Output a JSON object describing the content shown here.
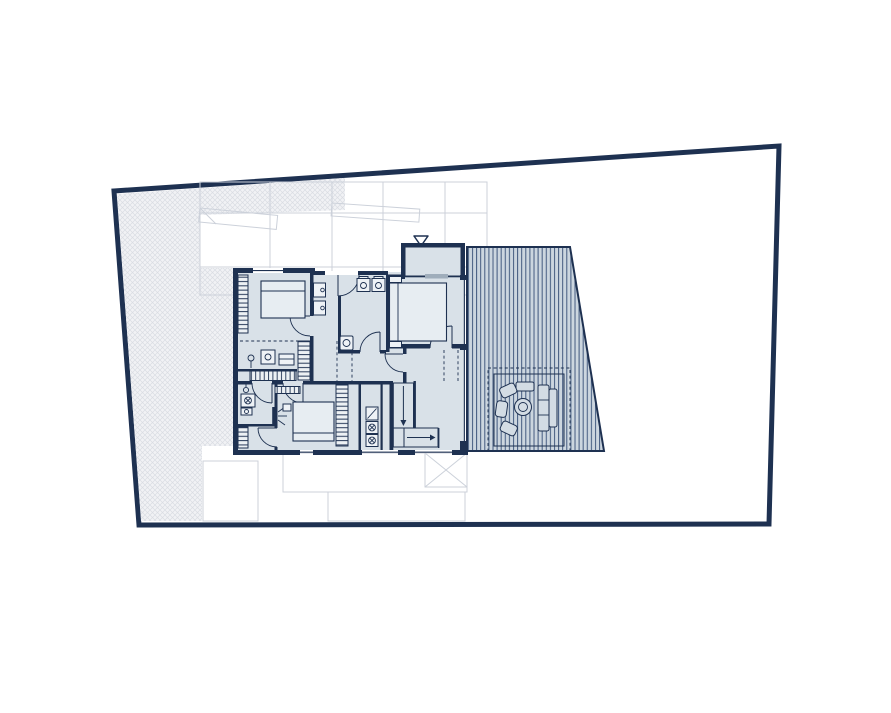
{
  "document": {
    "kind": "architectural-floor-plan",
    "visible_text": "",
    "description_labels": {
      "property_boundary": "property-boundary",
      "hatched_ground": "hatched-ground-area",
      "neighbor_outline": "neighbor-structure-outline",
      "lower_level": "lower-level-outline",
      "entrance_marker": "entrance-marker",
      "roof_deck": "roof-deck",
      "seating": "outdoor-seating-area",
      "house": "upper-floor-plan",
      "stairs": "staircase",
      "wardrobes": "wardrobe-strips"
    }
  },
  "colors": {
    "navy": "#1e3151",
    "room": "#d9e1e8",
    "room-light": "#e7edf2",
    "deck": "#ccd6df",
    "deck-stripe": "#41597e",
    "hatch-bg": "#f1f2f5",
    "hatch-line": "#d9dce3",
    "faint": "#ccd1da",
    "window-bar": "#9fadbb",
    "chair": "#d3dce4",
    "bg": "#ffffff"
  },
  "icons": [
    {
      "name": "entrance-marker-icon",
      "glyph": "triangle-down-outline"
    },
    {
      "name": "washer-icon",
      "glyph": "square-with-crossed-circle"
    },
    {
      "name": "toilet-icon",
      "glyph": "square-with-circle"
    },
    {
      "name": "sink-icon",
      "glyph": "small-square-with-circle"
    },
    {
      "name": "lamp-icon",
      "glyph": "circle-with-stem"
    },
    {
      "name": "tv-icon",
      "glyph": "wall-bar-with-rays"
    },
    {
      "name": "stair-arrow-icon",
      "glyph": "direction-arrow"
    }
  ]
}
